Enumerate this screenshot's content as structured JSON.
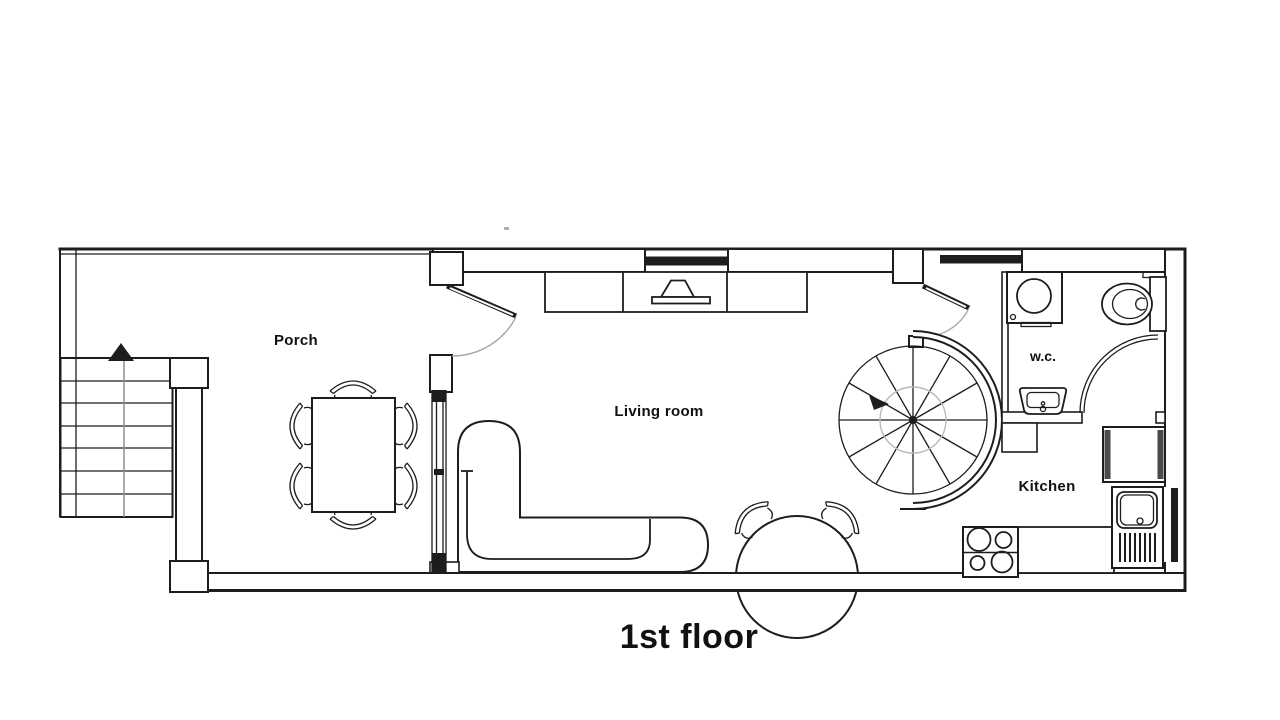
{
  "title": "1st floor",
  "rooms": {
    "porch": {
      "label": "Porch"
    },
    "living_room": {
      "label": "Living room"
    },
    "wc": {
      "label": "w.c."
    },
    "kitchen": {
      "label": "Kitchen"
    }
  },
  "colors": {
    "line": "#1d1d1d",
    "swing": "#a6a6a6",
    "window_fill": "#1d1d1d",
    "appliance_accent": "#4a4a4a",
    "background": "#ffffff"
  }
}
